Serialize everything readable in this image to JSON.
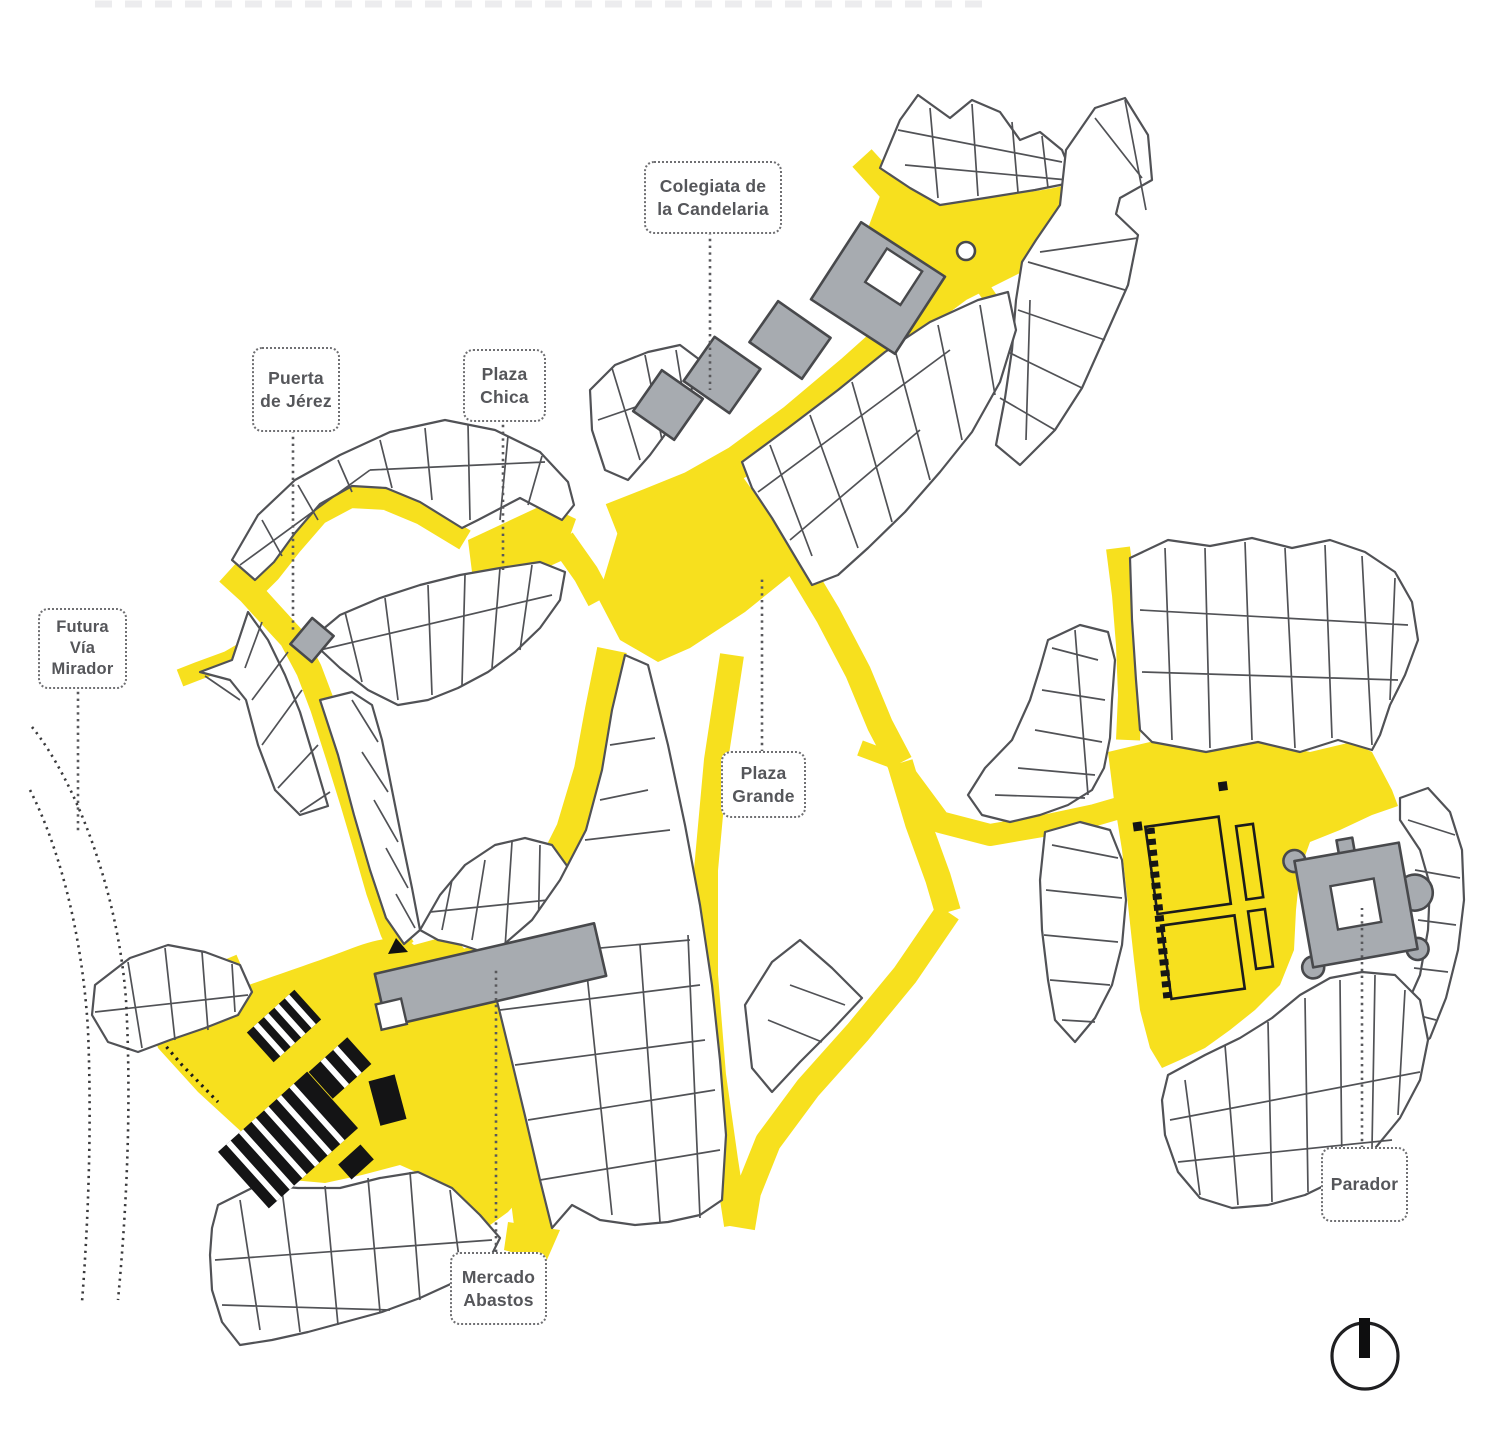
{
  "map": {
    "labels": {
      "colegiata": {
        "line1": "Colegiata de",
        "line2": "la Candelaria"
      },
      "puerta": {
        "line1": "Puerta",
        "line2": "de Jérez"
      },
      "plaza_chica": {
        "line1": "Plaza",
        "line2": "Chica"
      },
      "futura": {
        "line1": "Futura",
        "line2": "Vía",
        "line3": "Mirador"
      },
      "plaza_grande": {
        "line1": "Plaza",
        "line2": "Grande"
      },
      "mercado": {
        "line1": "Mercado",
        "line2": "Abastos"
      },
      "parador": {
        "line1": "Parador"
      }
    },
    "icons": {
      "north_indicator": "circle-with-north-bar"
    },
    "colors": {
      "street_yellow": "#F7E01E",
      "monument_gray": "#A7ABB0",
      "outline_gray": "#515256",
      "dark_line": "#48494C",
      "black_building": "#141415",
      "label_text": "#55565A",
      "background": "#FFFFFF"
    }
  }
}
